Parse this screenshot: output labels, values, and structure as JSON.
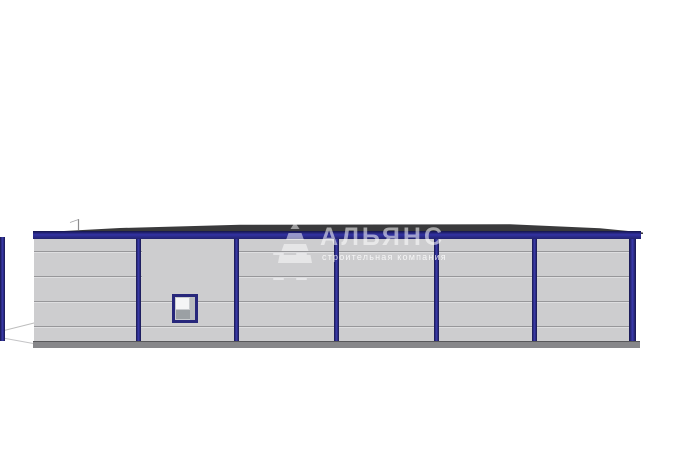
{
  "app": {
    "background": "#ffffff",
    "description": "3D elevation render of a single-storey prefabricated warehouse building"
  },
  "watermark": {
    "logo_icon": "stepped-pyramid-icon",
    "title": "АЛЬЯНС",
    "subtitle": "строительная компания"
  },
  "building": {
    "bays": 6,
    "columns": 7,
    "panel_rows": 5,
    "has_window": true,
    "colors": {
      "bg": "#ffffff",
      "wall": "#cdcdcf",
      "seam": "#97979a",
      "seam-highlight": "#e6e6e8",
      "frame-blue": "#3232a2",
      "column-dark": "#17174c",
      "column-light": "#3b3bae",
      "roof": "#3a3a3c",
      "plinth": "#87878a",
      "plinth-edge": "#58585b",
      "window-frame": "#27277b",
      "window-pane": "#f4f5f6",
      "window-shade": "#9ba0a4",
      "ground-line": "#bdbdbd",
      "antenna": "#8c8c8e"
    }
  }
}
